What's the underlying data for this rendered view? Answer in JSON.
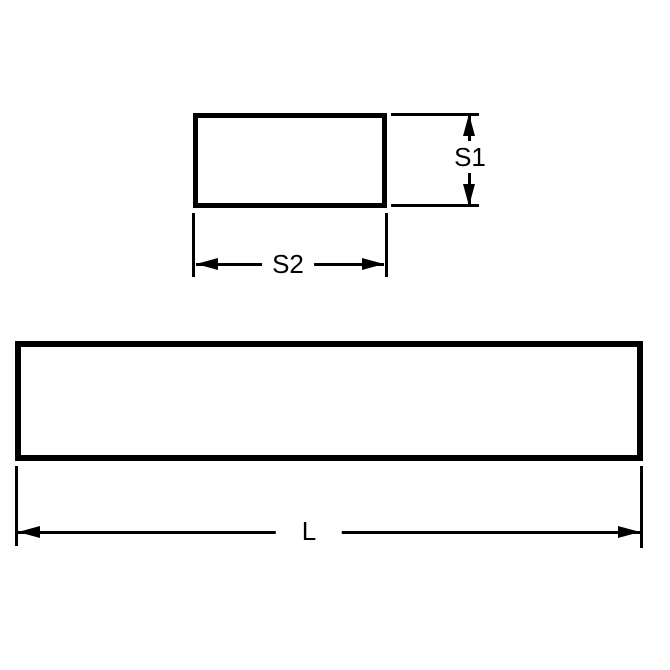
{
  "diagram": {
    "background_color": "#ffffff",
    "line_color": "#000000",
    "labels": {
      "s1": "S1",
      "s2": "S2",
      "l": "L"
    }
  }
}
